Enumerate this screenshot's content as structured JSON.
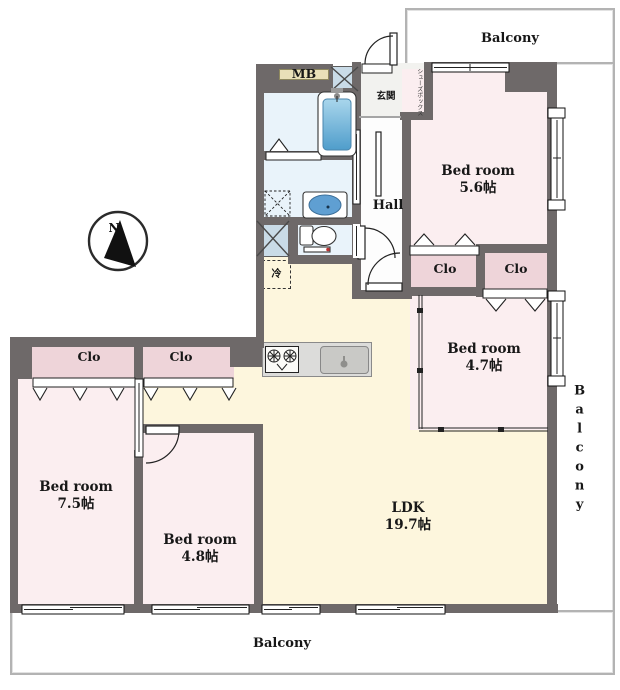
{
  "floor_plan": {
    "compass": {
      "north": "N"
    },
    "balconies": {
      "top": "Balcony",
      "right": "Balcony",
      "bottom": "Balcony"
    },
    "rooms": {
      "bedroom_a": {
        "label": "Bed room",
        "size": "5.6帖"
      },
      "bedroom_b": {
        "label": "Bed room",
        "size": "4.7帖"
      },
      "bedroom_c": {
        "label": "Bed room",
        "size": "7.5帖"
      },
      "bedroom_d": {
        "label": "Bed room",
        "size": "4.8帖"
      },
      "ldk": {
        "label": "LDK",
        "size": "19.7帖"
      },
      "hall": {
        "label": "Hall"
      },
      "entrance": {
        "label": "玄関"
      },
      "shoe_box": {
        "label": "シューズボックス"
      },
      "meter_box": {
        "label": "MB"
      },
      "refrigerator": {
        "label": "冷"
      },
      "closets": [
        "Clo",
        "Clo",
        "Clo",
        "Clo"
      ]
    },
    "colors": {
      "wall": "#6e6969",
      "bedroom_floor": "#fbeef0",
      "closet_floor": "#eed4d9",
      "ldk_floor": "#fdf6dd",
      "wet_area_floor": "#e9f3fa",
      "pipe_space": "#c9dbe7",
      "wood_accent": "#e9e0b8",
      "balcony_line": "#b3b3b3"
    }
  }
}
